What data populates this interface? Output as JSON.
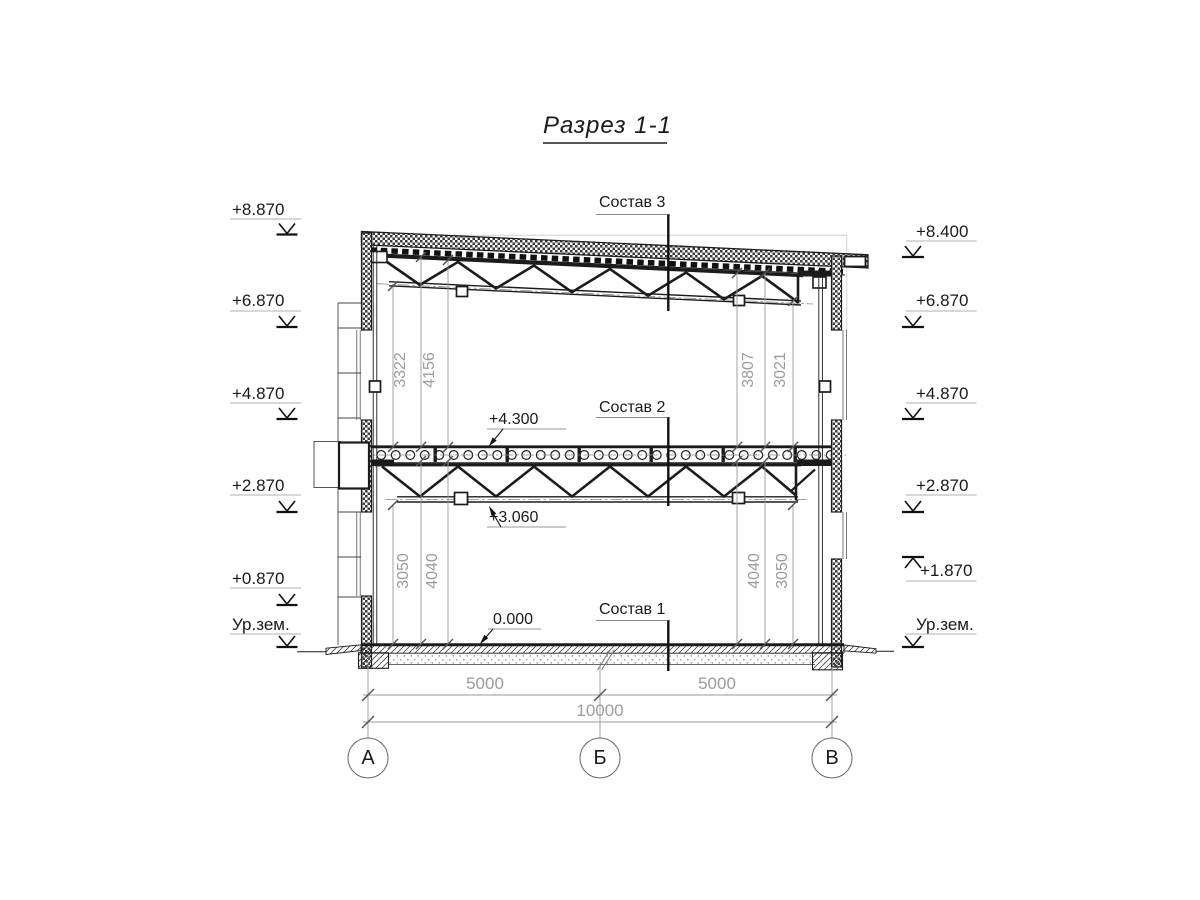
{
  "title": "Разрез 1-1",
  "composition_labels": {
    "c3": "Состав 3",
    "c2": "Состав 2",
    "c1": "Состав 1"
  },
  "elevation_marks": {
    "left": [
      "+8.870",
      "+6.870",
      "+4.870",
      "+2.870",
      "+0.870",
      "Ур.зем."
    ],
    "right": [
      "+8.400",
      "+6.870",
      "+4.870",
      "+2.870",
      "+1.870",
      "Ур.зем."
    ],
    "floor2_top": "+4.300",
    "truss2_bottom": "+3.060",
    "ground_floor": "0.000"
  },
  "dimensions": {
    "upper_left": [
      "3322",
      "4156"
    ],
    "upper_right": [
      "3807",
      "3021"
    ],
    "lower_left": [
      "3050",
      "4040"
    ],
    "lower_right": [
      "4040",
      "3050"
    ],
    "spans": [
      "5000",
      "5000"
    ],
    "total": "10000"
  },
  "axes": [
    "А",
    "Б",
    "В"
  ],
  "colors": {
    "line": "#1a1a1a",
    "dim_text": "#9c9c9c"
  }
}
